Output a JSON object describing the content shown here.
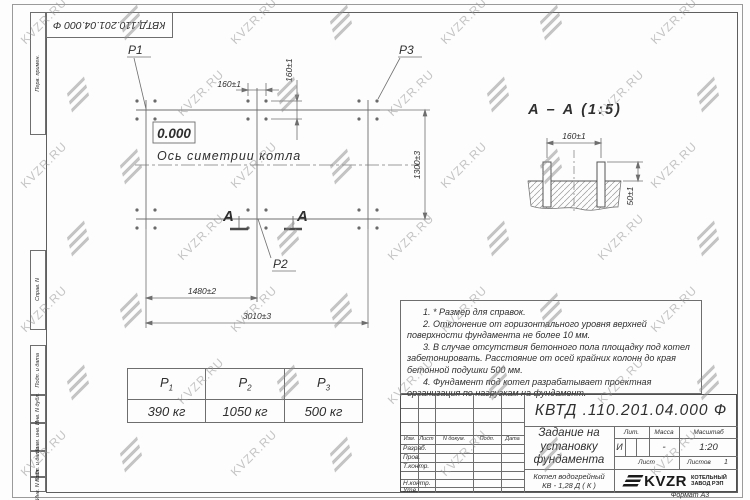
{
  "sheet": {
    "watermark_text": "KVZR.RU",
    "doc_number_rotated": "КВТД.110.201.04.000  Ф",
    "format_label": "Формат А3",
    "strip": [
      "Перв. примен.",
      "Справ. N",
      "Подп. и дата",
      "Инв. N дубл.",
      "Взам. инв. N",
      "Подп. и дата",
      "Инв. N подл."
    ]
  },
  "plan": {
    "p1": "P1",
    "p2": "P2",
    "p3": "P3",
    "level_mark": "0.000",
    "axis_label": "Ось симетрии котла",
    "section_letter": "А",
    "dim_160": "160±1",
    "dim_1300": "1300±3",
    "dim_1480": "1480±2",
    "dim_3010": "3010±3"
  },
  "section": {
    "title": "А – А (1:5)",
    "dim_160": "160±1",
    "dim_50": "50±1"
  },
  "loads_table": {
    "headers": [
      {
        "b": "P",
        "s": "1"
      },
      {
        "b": "P",
        "s": "2"
      },
      {
        "b": "P",
        "s": "3"
      }
    ],
    "values": [
      "390 кг",
      "1050 кг",
      "500 кг"
    ]
  },
  "notes": [
    "1. * Размер для справок.",
    "2. Отклонение от горизонтального уровня верхней поверхности фундамента не более 10 мм.",
    "3. В случае отсутствия бетонного пола площадку под котел забетонировать. Расстояние от осей крайних колонн до края бетонной подушки 500 мм.",
    "4. Фундамент под котел разрабатывает проектная организация по нагрузкам на фундамент."
  ],
  "title_block": {
    "doc_number": "КВТД .110.201.04.000  Ф",
    "header_cols": [
      "Изм.",
      "Лист",
      "N докум.",
      "Подп.",
      "Дата"
    ],
    "row_labels": [
      "Разраб.",
      "Пров.",
      "Т.контр.",
      "Н.контр.",
      "Утв."
    ],
    "title_lines": [
      "Задание на",
      "установку",
      "фундамента"
    ],
    "product_lines": [
      "Котел водогрейный",
      "КВ - 1,28  Д  ( К )"
    ],
    "lit_label": "Лит.",
    "lit_value": "И",
    "mass_label": "Масса",
    "mass_value": "-",
    "scale_label": "Масштаб",
    "scale_value": "1:20",
    "sheet_label": "Лист",
    "sheets_label": "Листов",
    "sheets_value": "1",
    "logo_text": "KVZR",
    "logo_sub": [
      "КОТЕЛЬНЫЙ",
      "ЗАВОД РЭП"
    ]
  }
}
